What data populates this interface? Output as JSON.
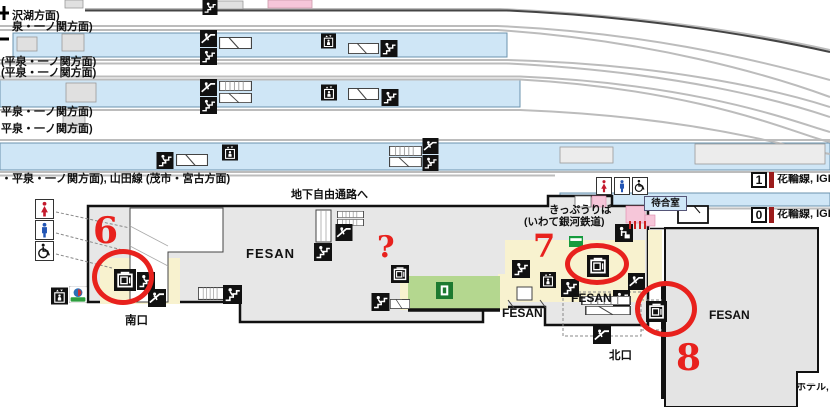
{
  "colors": {
    "platform_blue": "#cfe6f6",
    "building_gray": "#e7e7e7",
    "zone_green": "#b4d78f",
    "zone_cream": "#f8f2cf",
    "zone_pink": "#f6c6d9",
    "annotation_red": "#e8211d",
    "line_bar_red": "#9b1b1b"
  },
  "track_labels": {
    "l1": "沢湖方面)",
    "l2": "泉・一ノ関方面)",
    "l3": "(平泉・一ノ関方面)",
    "l4": "(平泉・一ノ関方面)",
    "l5": "平泉・一ノ関方面)",
    "l6": "平泉・一ノ関方面)",
    "l7": "・平泉・一ノ関方面), 山田線 (茂市・宮古方面)"
  },
  "station": {
    "underground_passage": "地下自由通路へ",
    "ticket_office": "きっぷうりば",
    "ticket_office_operator": "(いわて銀河鉄道)",
    "waiting_room": "待合室",
    "south_exit": "南口",
    "north_exit": "北口",
    "hotel": "ホテル,",
    "fesan": [
      "FESAN",
      "FESAN",
      "FESAN",
      "FESAN"
    ]
  },
  "platforms": [
    {
      "number": "1",
      "line": "花輪線, IGR"
    },
    {
      "number": "0",
      "line": "花輪線, IGR"
    }
  ],
  "annotations": {
    "marker6": "6",
    "marker7": "7",
    "marker8": "8",
    "question": "?"
  }
}
